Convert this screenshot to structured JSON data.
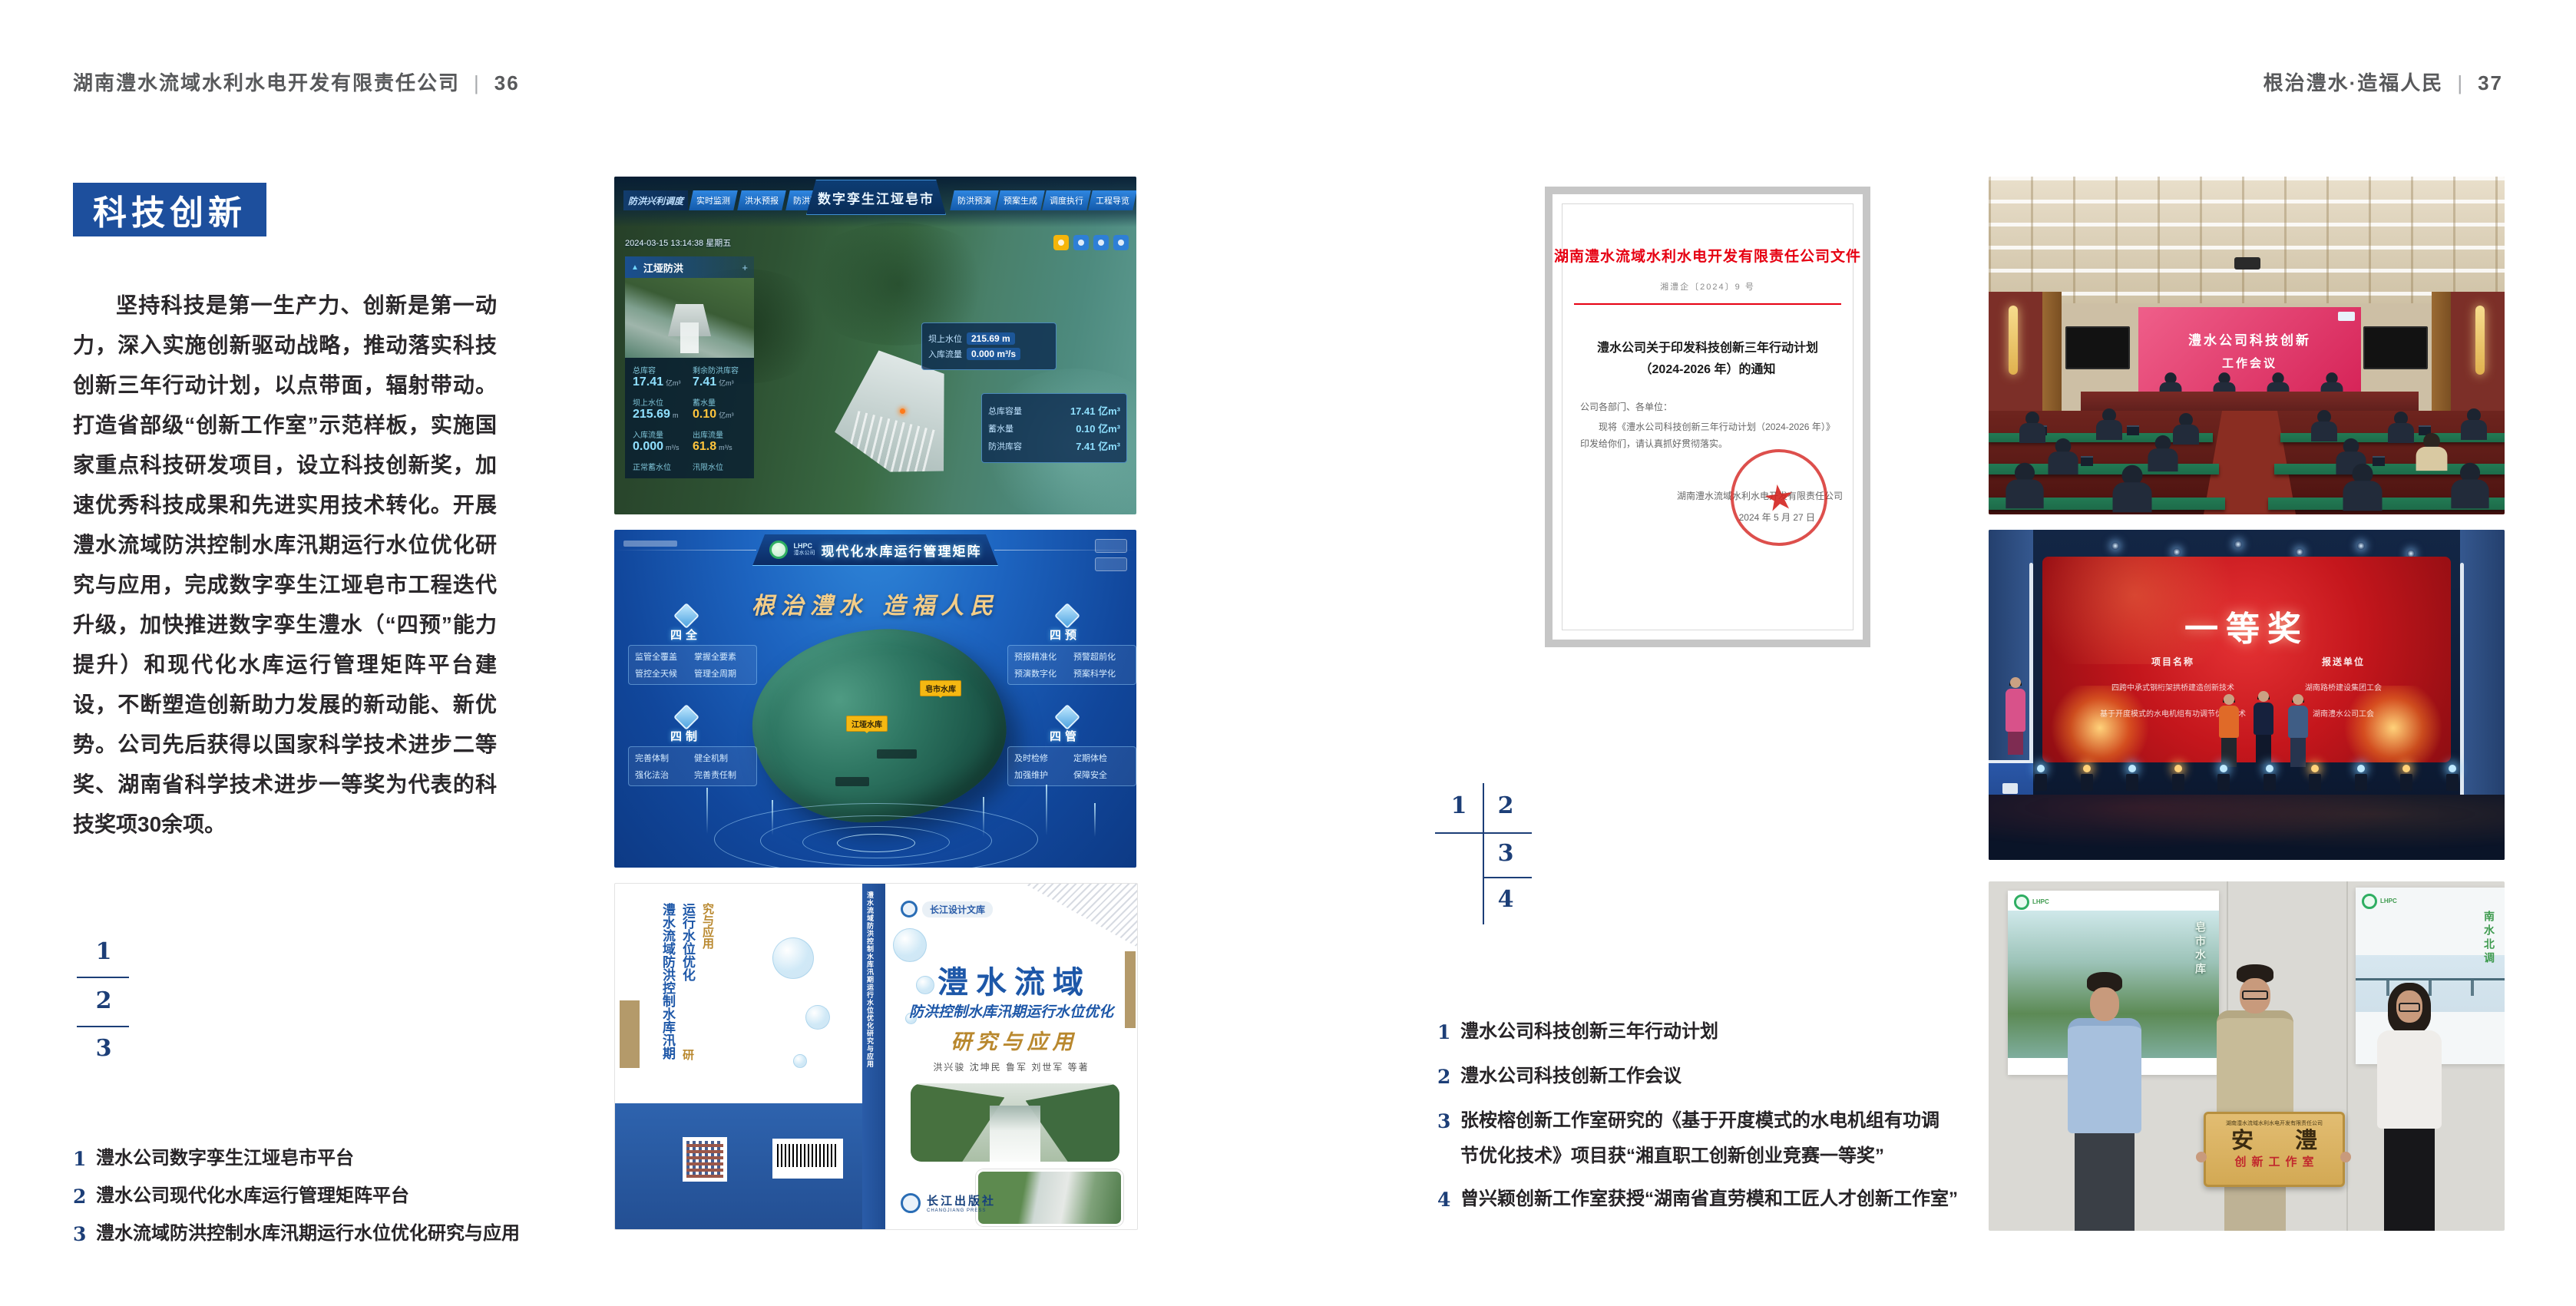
{
  "page_left": {
    "header_title": "湖南澧水流域水利水电开发有限责任公司",
    "header_sep": "|",
    "header_page": "36",
    "badge": "科技创新",
    "body": "坚持科技是第一生产力、创新是第一动力，深入实施创新驱动战略，推动落实科技创新三年行动计划，以点带面，辐射带动。打造省部级“创新工作室”示范样板，实施国家重点科技研发项目，设立科技创新奖，加速优秀科技成果和先进实用技术转化。开展澧水流域防洪控制水库汛期运行水位优化研究与应用，完成数字孪生江垭皂市工程迭代升级，加快推进数字孪生澧水（“四预”能力提升）和现代化水库运行管理矩阵平台建设，不断塑造创新助力发展的新动能、新优势。公司先后获得以国家科学技术进步二等奖、湖南省科学技术进步一等奖为代表的科技奖项30余项。",
    "figure_index": {
      "n1": "1",
      "n2": "2",
      "n3": "3"
    },
    "captions": [
      {
        "num": "1",
        "text": "澧水公司数字孪生江垭皂市平台"
      },
      {
        "num": "2",
        "text": "澧水公司现代化水库运行管理矩阵平台"
      },
      {
        "num": "3",
        "text": "澧水流域防洪控制水库汛期运行水位优化研究与应用"
      }
    ]
  },
  "page_right": {
    "header_title": "根治澧水·造福人民",
    "header_sep": "|",
    "header_page": "37",
    "figure_index": {
      "n1": "1",
      "n2": "2",
      "n3": "3",
      "n4": "4"
    },
    "captions": [
      {
        "num": "1",
        "text": "澧水公司科技创新三年行动计划"
      },
      {
        "num": "2",
        "text": "澧水公司科技创新工作会议"
      },
      {
        "num": "3",
        "text": "张桉榕创新工作室研究的《基于开度模式的水电机组有功调节优化技术》项目获“湘直职工创新创业竞赛一等奖”"
      },
      {
        "num": "4",
        "text": "曾兴颖创新工作室获授“湖南省直劳模和工匠人才创新工作室”"
      }
    ]
  },
  "dashboard": {
    "title": "数字孪生江垭皂市",
    "nav_label": "防洪兴利调度",
    "tabs_left": [
      "实时监测",
      "洪水预报",
      "防洪预警"
    ],
    "tabs_right": [
      "防洪预演",
      "预案生成",
      "调度执行",
      "工程导览"
    ],
    "timestamp": "2024-03-15 13:14:38 星期五",
    "panel_title": "江垭防洪",
    "panel_plus": "+",
    "stats": [
      {
        "label": "总库容",
        "value": "17.41",
        "unit": "亿m³"
      },
      {
        "label": "剩余防洪库容",
        "value": "7.41",
        "unit": "亿m³"
      },
      {
        "label": "坝上水位",
        "value": "215.69",
        "unit": "m"
      },
      {
        "label": "蓄水量",
        "value": "0.10",
        "unit": "亿m³"
      },
      {
        "label": "入库流量",
        "value": "0.000",
        "unit": "m³/s"
      },
      {
        "label": "出库流量",
        "value": "61.8",
        "unit": "m³/s"
      },
      {
        "label": "正常蓄水位",
        "value": "",
        "unit": ""
      },
      {
        "label": "汛限水位",
        "value": "",
        "unit": ""
      }
    ],
    "callout": {
      "label1": "坝上水位",
      "value1": "215.69 m",
      "label2": "入库流量",
      "value2": "0.000 m³/s"
    },
    "info": [
      {
        "label": "总库容量",
        "value": "17.41 亿m³"
      },
      {
        "label": "蓄水量",
        "value": "0.10 亿m³"
      },
      {
        "label": "防洪库容",
        "value": "7.41 亿m³"
      }
    ]
  },
  "matrix": {
    "logo_abbr": "LHPC",
    "logo_name": "澧水公司",
    "title": "现代化水库运行管理矩阵",
    "slogan": "根治澧水 造福人民",
    "panel_tl": {
      "title": "四全",
      "items": [
        "监管全覆盖",
        "掌握全要素",
        "管控全天候",
        "管理全周期"
      ]
    },
    "panel_tr": {
      "title": "四预",
      "items": [
        "预报精准化",
        "预警超前化",
        "预演数字化",
        "预案科学化"
      ]
    },
    "panel_bl": {
      "title": "四制",
      "items": [
        "完善体制",
        "健全机制",
        "强化法治",
        "完善责任制"
      ]
    },
    "panel_br": {
      "title": "四管",
      "items": [
        "及时检修",
        "定期体检",
        "加强维护",
        "保障安全"
      ]
    },
    "map_label_1": "皂市水库",
    "map_label_2": "江垭水库"
  },
  "book": {
    "series": "长江设计文库",
    "title_main": "澧水流域",
    "title_sub": "防洪控制水库汛期运行水位优化",
    "title_tail": "研究与应用",
    "authors": "洪兴骏 沈坤民 鲁军 刘世军 等著",
    "publisher": "长江出版社",
    "publisher_en": "CHANGJIANG PRESS",
    "spine": "澧水流域防洪控制水库汛期运行水位优化研究与应用"
  },
  "document": {
    "header": "湖南澧水流域水利水电开发有限责任公司文件",
    "doc_no": "湘澧企〔2024〕9 号",
    "title_line1": "澧水公司关于印发科技创新三年行动计划",
    "title_line2": "（2024-2026 年）的通知",
    "salutation": "公司各部门、各单位：",
    "body": "现将《澧水公司科技创新三年行动计划（2024-2026 年）》印发给你们，请认真抓好贯彻落实。",
    "signer": "湖南澧水流域水利水电开发有限责任公司",
    "date": "2024 年 5 月 27 日",
    "seal_star": "★"
  },
  "meeting": {
    "screen_line1": "澧水公司科技创新",
    "screen_line2": "工作会议"
  },
  "award": {
    "title": "一等奖",
    "col_project": "项目名称",
    "col_unit": "报送单位",
    "rows": [
      {
        "project": "四跨中承式钢桁架拱桥建造创新技术",
        "unit": "湖南路桥建设集团工会"
      },
      {
        "project": "基于开度模式的水电机组有功调节优化技术",
        "unit": "湖南澧水公司工会"
      }
    ]
  },
  "workshop": {
    "plaque_header": "湖南澧水流域水利水电开发有限责任公司",
    "plaque_main": "安 澧",
    "plaque_sub": "创新工作室",
    "poster_left_text": "皂市水库",
    "poster_right_text": "南水北调",
    "poster_logo": "LHPC"
  }
}
